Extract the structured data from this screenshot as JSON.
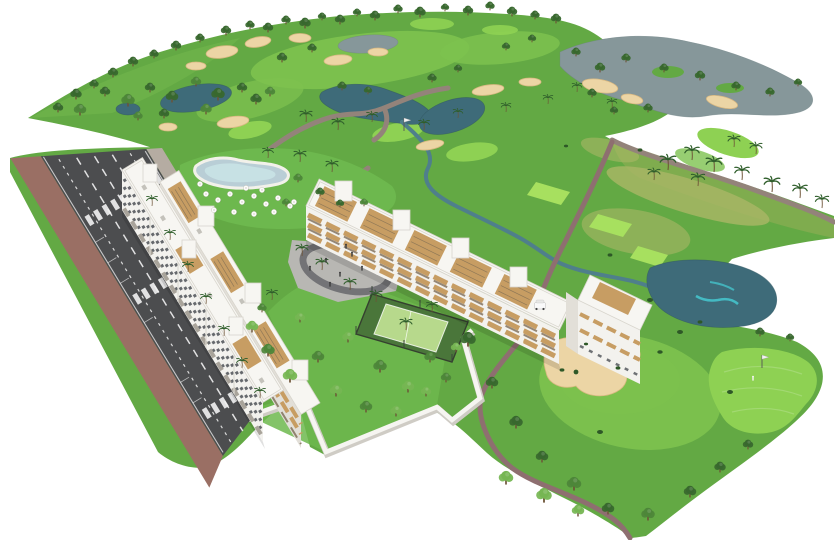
{
  "canvas": {
    "width": 835,
    "height": 540,
    "background": "#ffffff",
    "description": "Aerial isometric 3D architectural rendering: white apartment residences with pool, plaza and padel court beside a golf course with ponds, bunkers and a tree-lined road"
  },
  "colors": {
    "landBase": "#63a944",
    "landLight": "#71b54c",
    "fairway": "#7dc24f",
    "greenBright": "#8ed153",
    "tee": "#a7e05f",
    "rough": "#8fae55",
    "dryGrass": "#aab766",
    "gardenLawn": "#6db84e",
    "pondDark": "#3e6b79",
    "pondMid": "#4f7f8b",
    "pondAqua": "#45c3cb",
    "lakeGray": "#86979a",
    "sand": "#ecd5a5",
    "sandEdge": "#d9b982",
    "pathTan": "#93837a",
    "pathMauve": "#8e6f70",
    "asphalt": "#4c4d4f",
    "laneMark": "#f2f2f2",
    "sidewalkBrick": "#9a6f64",
    "sidewalkGray": "#b5aca2",
    "wallWhite": "#f6f5f1",
    "wallShadow": "#cfccc5",
    "facadeWhite": "#f3f2ee",
    "facadeShade": "#e2dfd8",
    "windowDark": "#4e5257",
    "balconyTan": "#c79d63",
    "balconyShadow": "#6e5b44",
    "roofWhite": "#f7f6f2",
    "roofLine": "#d8d5cd",
    "treeDark": "#38682e",
    "treeMid": "#4d8639",
    "treeLight": "#76b653",
    "bushDark": "#2e5827",
    "palmGreen": "#2f5e2b",
    "trunkBrown": "#6d5336",
    "plazaGray": "#b8b7b3",
    "plazaRing": "#737376",
    "courtGreen": "#b7d98c",
    "courtSurround": "#4a763a",
    "poolWater": "#b9ced6",
    "poolAqua": "#cde9e9",
    "poolDeck": "#f2f1ea",
    "carRed": "#c0392b",
    "carTeal": "#1e8e96",
    "carBlue": "#2c5f9e",
    "carGreen": "#4a7c46",
    "carWhite": "#f5f5f5",
    "carSilver": "#c8c8c8",
    "carGray": "#8a8d90",
    "carDark": "#3c3f42",
    "flagPole": "#555555",
    "figure": "#3a3a3a"
  },
  "icons": {
    "tree-icon": "clustered green circles with trunk",
    "palm-tree-icon": "radiating frond strokes on curved trunk",
    "bush-icon": "small dark green ellipse",
    "parasol-icon": "white circle umbrella",
    "car-icon": "rounded rectangle with dark cabin",
    "person-icon": "dot head over short bar",
    "flag-icon": "pole with light pennant",
    "golf-cart-icon": "small white cart with canopy"
  },
  "counts": {
    "apartment_buildings": 2,
    "ponds": 7,
    "sand_bunkers": 11,
    "tee_boxes": 3,
    "putting_greens": 4,
    "flags": 2,
    "golfers": 1,
    "golf_carts": 1,
    "padel_courts": 1,
    "swimming_pools": 1,
    "crosswalks": 3,
    "road_lanes": 4,
    "parked_cars": 13,
    "moving_cars": 6,
    "parasols": 16
  },
  "scene": {
    "trees_bg": [
      [
        268,
        32,
        1,
        "d"
      ],
      [
        286,
        24,
        0.9,
        "d"
      ],
      [
        305,
        28,
        1.1,
        "d"
      ],
      [
        322,
        20,
        0.8,
        "d"
      ],
      [
        340,
        24,
        1,
        "d"
      ],
      [
        357,
        16,
        0.8,
        "d"
      ],
      [
        375,
        20,
        1,
        "d"
      ],
      [
        398,
        13,
        0.9,
        "d"
      ],
      [
        420,
        17,
        1.1,
        "d"
      ],
      [
        445,
        11,
        0.8,
        "d"
      ],
      [
        468,
        15,
        1,
        "d"
      ],
      [
        490,
        10,
        0.9,
        "d"
      ],
      [
        512,
        16,
        1,
        "d"
      ],
      [
        535,
        19,
        0.9,
        "d"
      ],
      [
        556,
        23,
        1,
        "d"
      ],
      [
        58,
        112,
        1,
        "d"
      ],
      [
        76,
        99,
        1.1,
        "d"
      ],
      [
        94,
        88,
        0.9,
        "d"
      ],
      [
        113,
        77,
        1,
        "d"
      ],
      [
        133,
        66,
        1,
        "d"
      ],
      [
        154,
        58,
        0.9,
        "d"
      ],
      [
        176,
        50,
        1,
        "d"
      ],
      [
        200,
        42,
        0.9,
        "d"
      ],
      [
        226,
        35,
        1,
        "d"
      ],
      [
        250,
        29,
        0.9,
        "d"
      ],
      [
        80,
        115,
        1.2,
        "m"
      ],
      [
        105,
        96,
        1,
        "d"
      ],
      [
        128,
        106,
        1.3,
        "m"
      ],
      [
        150,
        92,
        1,
        "d"
      ],
      [
        172,
        102,
        1.2,
        "d"
      ],
      [
        196,
        86,
        1,
        "m"
      ],
      [
        218,
        100,
        1.3,
        "d"
      ],
      [
        242,
        92,
        1,
        "d"
      ],
      [
        206,
        114,
        1.1,
        "m"
      ],
      [
        164,
        118,
        1,
        "d"
      ],
      [
        138,
        120,
        0.9,
        "m"
      ],
      [
        256,
        104,
        1.1,
        "d"
      ],
      [
        282,
        62,
        1,
        "d"
      ],
      [
        312,
        52,
        0.9,
        "d"
      ],
      [
        270,
        96,
        1,
        "m"
      ],
      [
        342,
        90,
        0.9,
        "d"
      ],
      [
        368,
        94,
        0.8,
        "d"
      ],
      [
        432,
        82,
        0.9,
        "d"
      ],
      [
        458,
        72,
        0.8,
        "d"
      ],
      [
        506,
        50,
        0.8,
        "d"
      ],
      [
        532,
        42,
        0.8,
        "d"
      ],
      [
        576,
        56,
        0.9,
        "d"
      ],
      [
        600,
        72,
        1,
        "d"
      ],
      [
        626,
        62,
        0.9,
        "d"
      ],
      [
        592,
        97,
        0.9,
        "d"
      ],
      [
        614,
        114,
        0.8,
        "d"
      ],
      [
        648,
        112,
        0.9,
        "d"
      ],
      [
        664,
        72,
        0.9,
        "d"
      ],
      [
        700,
        80,
        1,
        "d"
      ],
      [
        736,
        90,
        0.9,
        "d"
      ],
      [
        770,
        96,
        0.9,
        "d"
      ],
      [
        798,
        86,
        0.8,
        "d"
      ]
    ],
    "trees_fg": [
      [
        468,
        346,
        1.5,
        "d"
      ],
      [
        492,
        388,
        1.2,
        "d"
      ],
      [
        516,
        428,
        1.3,
        "d"
      ],
      [
        542,
        462,
        1.2,
        "d"
      ],
      [
        574,
        490,
        1.4,
        "m"
      ],
      [
        608,
        514,
        1.2,
        "d"
      ],
      [
        648,
        520,
        1.3,
        "m"
      ],
      [
        690,
        497,
        1.2,
        "d"
      ],
      [
        720,
        472,
        1.1,
        "d"
      ],
      [
        748,
        449,
        1,
        "d"
      ],
      [
        506,
        484,
        1.4,
        "l"
      ],
      [
        544,
        502,
        1.5,
        "l"
      ],
      [
        578,
        516,
        1.2,
        "l"
      ],
      [
        760,
        336,
        0.9,
        "d"
      ],
      [
        790,
        341,
        0.8,
        "d"
      ],
      [
        252,
        332,
        1.2,
        "l"
      ],
      [
        268,
        356,
        1.3,
        "m"
      ],
      [
        290,
        382,
        1.4,
        "l"
      ],
      [
        318,
        362,
        1.2,
        "m"
      ],
      [
        348,
        342,
        1.1,
        "l"
      ],
      [
        380,
        372,
        1.3,
        "m"
      ],
      [
        300,
        322,
        1,
        "l"
      ],
      [
        262,
        312,
        0.9,
        "m"
      ],
      [
        408,
        392,
        1.2,
        "l"
      ],
      [
        430,
        362,
        1.1,
        "m"
      ],
      [
        336,
        396,
        1.2,
        "l"
      ],
      [
        366,
        412,
        1.2,
        "m"
      ],
      [
        396,
        416,
        1.1,
        "l"
      ],
      [
        426,
        396,
        1,
        "l"
      ],
      [
        446,
        382,
        1,
        "m"
      ],
      [
        456,
        352,
        1,
        "l"
      ],
      [
        298,
        182,
        0.9,
        "m"
      ],
      [
        320,
        196,
        0.9,
        "d"
      ],
      [
        286,
        206,
        0.8,
        "m"
      ],
      [
        340,
        207,
        0.8,
        "d"
      ],
      [
        364,
        206,
        0.8,
        "m"
      ]
    ],
    "palms_bg": [
      [
        306,
        122,
        1
      ],
      [
        338,
        130,
        1
      ],
      [
        372,
        122,
        0.9
      ],
      [
        300,
        162,
        1
      ],
      [
        332,
        172,
        1
      ],
      [
        268,
        158,
        0.9
      ],
      [
        424,
        130,
        0.9
      ],
      [
        458,
        118,
        0.8
      ],
      [
        506,
        112,
        0.8
      ],
      [
        548,
        104,
        0.8
      ],
      [
        577,
        92,
        0.8
      ],
      [
        612,
        108,
        0.8
      ],
      [
        668,
        170,
        1.3
      ],
      [
        692,
        160,
        1.2
      ],
      [
        714,
        172,
        1.3
      ],
      [
        742,
        180,
        1.2
      ],
      [
        772,
        192,
        1.3
      ],
      [
        800,
        198,
        1.2
      ],
      [
        822,
        208,
        1.1
      ],
      [
        756,
        154,
        1
      ],
      [
        734,
        147,
        1
      ],
      [
        698,
        186,
        1.1
      ],
      [
        654,
        180,
        1
      ]
    ],
    "palms_fg": [
      [
        302,
        256,
        1
      ],
      [
        322,
        270,
        1
      ],
      [
        350,
        290,
        1
      ],
      [
        376,
        302,
        1
      ],
      [
        272,
        300,
        0.9
      ],
      [
        406,
        330,
        1
      ],
      [
        432,
        312,
        0.9
      ],
      [
        152,
        206,
        0.9
      ],
      [
        170,
        240,
        0.9
      ],
      [
        188,
        272,
        0.9
      ],
      [
        206,
        304,
        0.9
      ],
      [
        224,
        336,
        0.9
      ],
      [
        242,
        368,
        0.9
      ],
      [
        260,
        398,
        0.9
      ]
    ],
    "bushes": [
      [
        650,
        300,
        1
      ],
      [
        680,
        332,
        1
      ],
      [
        700,
        322,
        0.8
      ],
      [
        600,
        432,
        1
      ],
      [
        660,
        352,
        0.9
      ],
      [
        730,
        392,
        1
      ],
      [
        562,
        370,
        0.8
      ],
      [
        618,
        368,
        0.8
      ],
      [
        586,
        344,
        0.7
      ],
      [
        640,
        150,
        0.8
      ],
      [
        566,
        146,
        0.7
      ],
      [
        610,
        255,
        0.8
      ]
    ],
    "parasols": [
      [
        206,
        194
      ],
      [
        218,
        200
      ],
      [
        230,
        194
      ],
      [
        242,
        202
      ],
      [
        254,
        196
      ],
      [
        266,
        204
      ],
      [
        278,
        198
      ],
      [
        290,
        206
      ],
      [
        214,
        210
      ],
      [
        234,
        212
      ],
      [
        254,
        214
      ],
      [
        274,
        212
      ],
      [
        294,
        202
      ],
      [
        200,
        184
      ],
      [
        246,
        188
      ],
      [
        262,
        190
      ]
    ],
    "cars": [
      [
        6,
        21,
        "silver"
      ],
      [
        30,
        21,
        "gray"
      ],
      [
        78,
        21,
        "white"
      ],
      [
        102,
        21,
        "dark"
      ],
      [
        152,
        21,
        "silver"
      ],
      [
        176,
        21,
        "green"
      ],
      [
        12,
        111,
        "blue"
      ],
      [
        58,
        111,
        "silver"
      ],
      [
        82,
        111,
        "green"
      ],
      [
        128,
        111,
        "dark"
      ],
      [
        198,
        111,
        "teal"
      ],
      [
        222,
        111,
        "gray"
      ],
      [
        246,
        111,
        "silver"
      ],
      [
        58,
        72,
        "red"
      ],
      [
        58,
        88,
        "teal"
      ],
      [
        8,
        44,
        "white"
      ],
      [
        146,
        82,
        "blue"
      ],
      [
        224,
        56,
        "silver"
      ],
      [
        252,
        88,
        "white"
      ]
    ],
    "road_people": [
      [
        40,
        120
      ],
      [
        90,
        118
      ],
      [
        140,
        122
      ],
      [
        108,
        60
      ],
      [
        60,
        6
      ],
      [
        170,
        4
      ]
    ],
    "plaza_people": [
      [
        326,
        262
      ],
      [
        340,
        276
      ],
      [
        352,
        256
      ],
      [
        362,
        270
      ],
      [
        330,
        286
      ],
      [
        310,
        270
      ],
      [
        346,
        248
      ]
    ],
    "playground_dots": [
      [
        318,
        252,
        "#e74c3c"
      ],
      [
        330,
        258,
        "#3498db"
      ],
      [
        350,
        250,
        "#f1c40f"
      ],
      [
        360,
        262,
        "#9b59b6"
      ],
      [
        342,
        272,
        "#2ecc71"
      ],
      [
        306,
        258,
        "#e67e22"
      ]
    ],
    "flags": [
      [
        404,
        131
      ],
      [
        762,
        368
      ]
    ],
    "golfers": [
      [
        753,
        380
      ]
    ],
    "carts": [
      [
        540,
        306
      ]
    ]
  }
}
